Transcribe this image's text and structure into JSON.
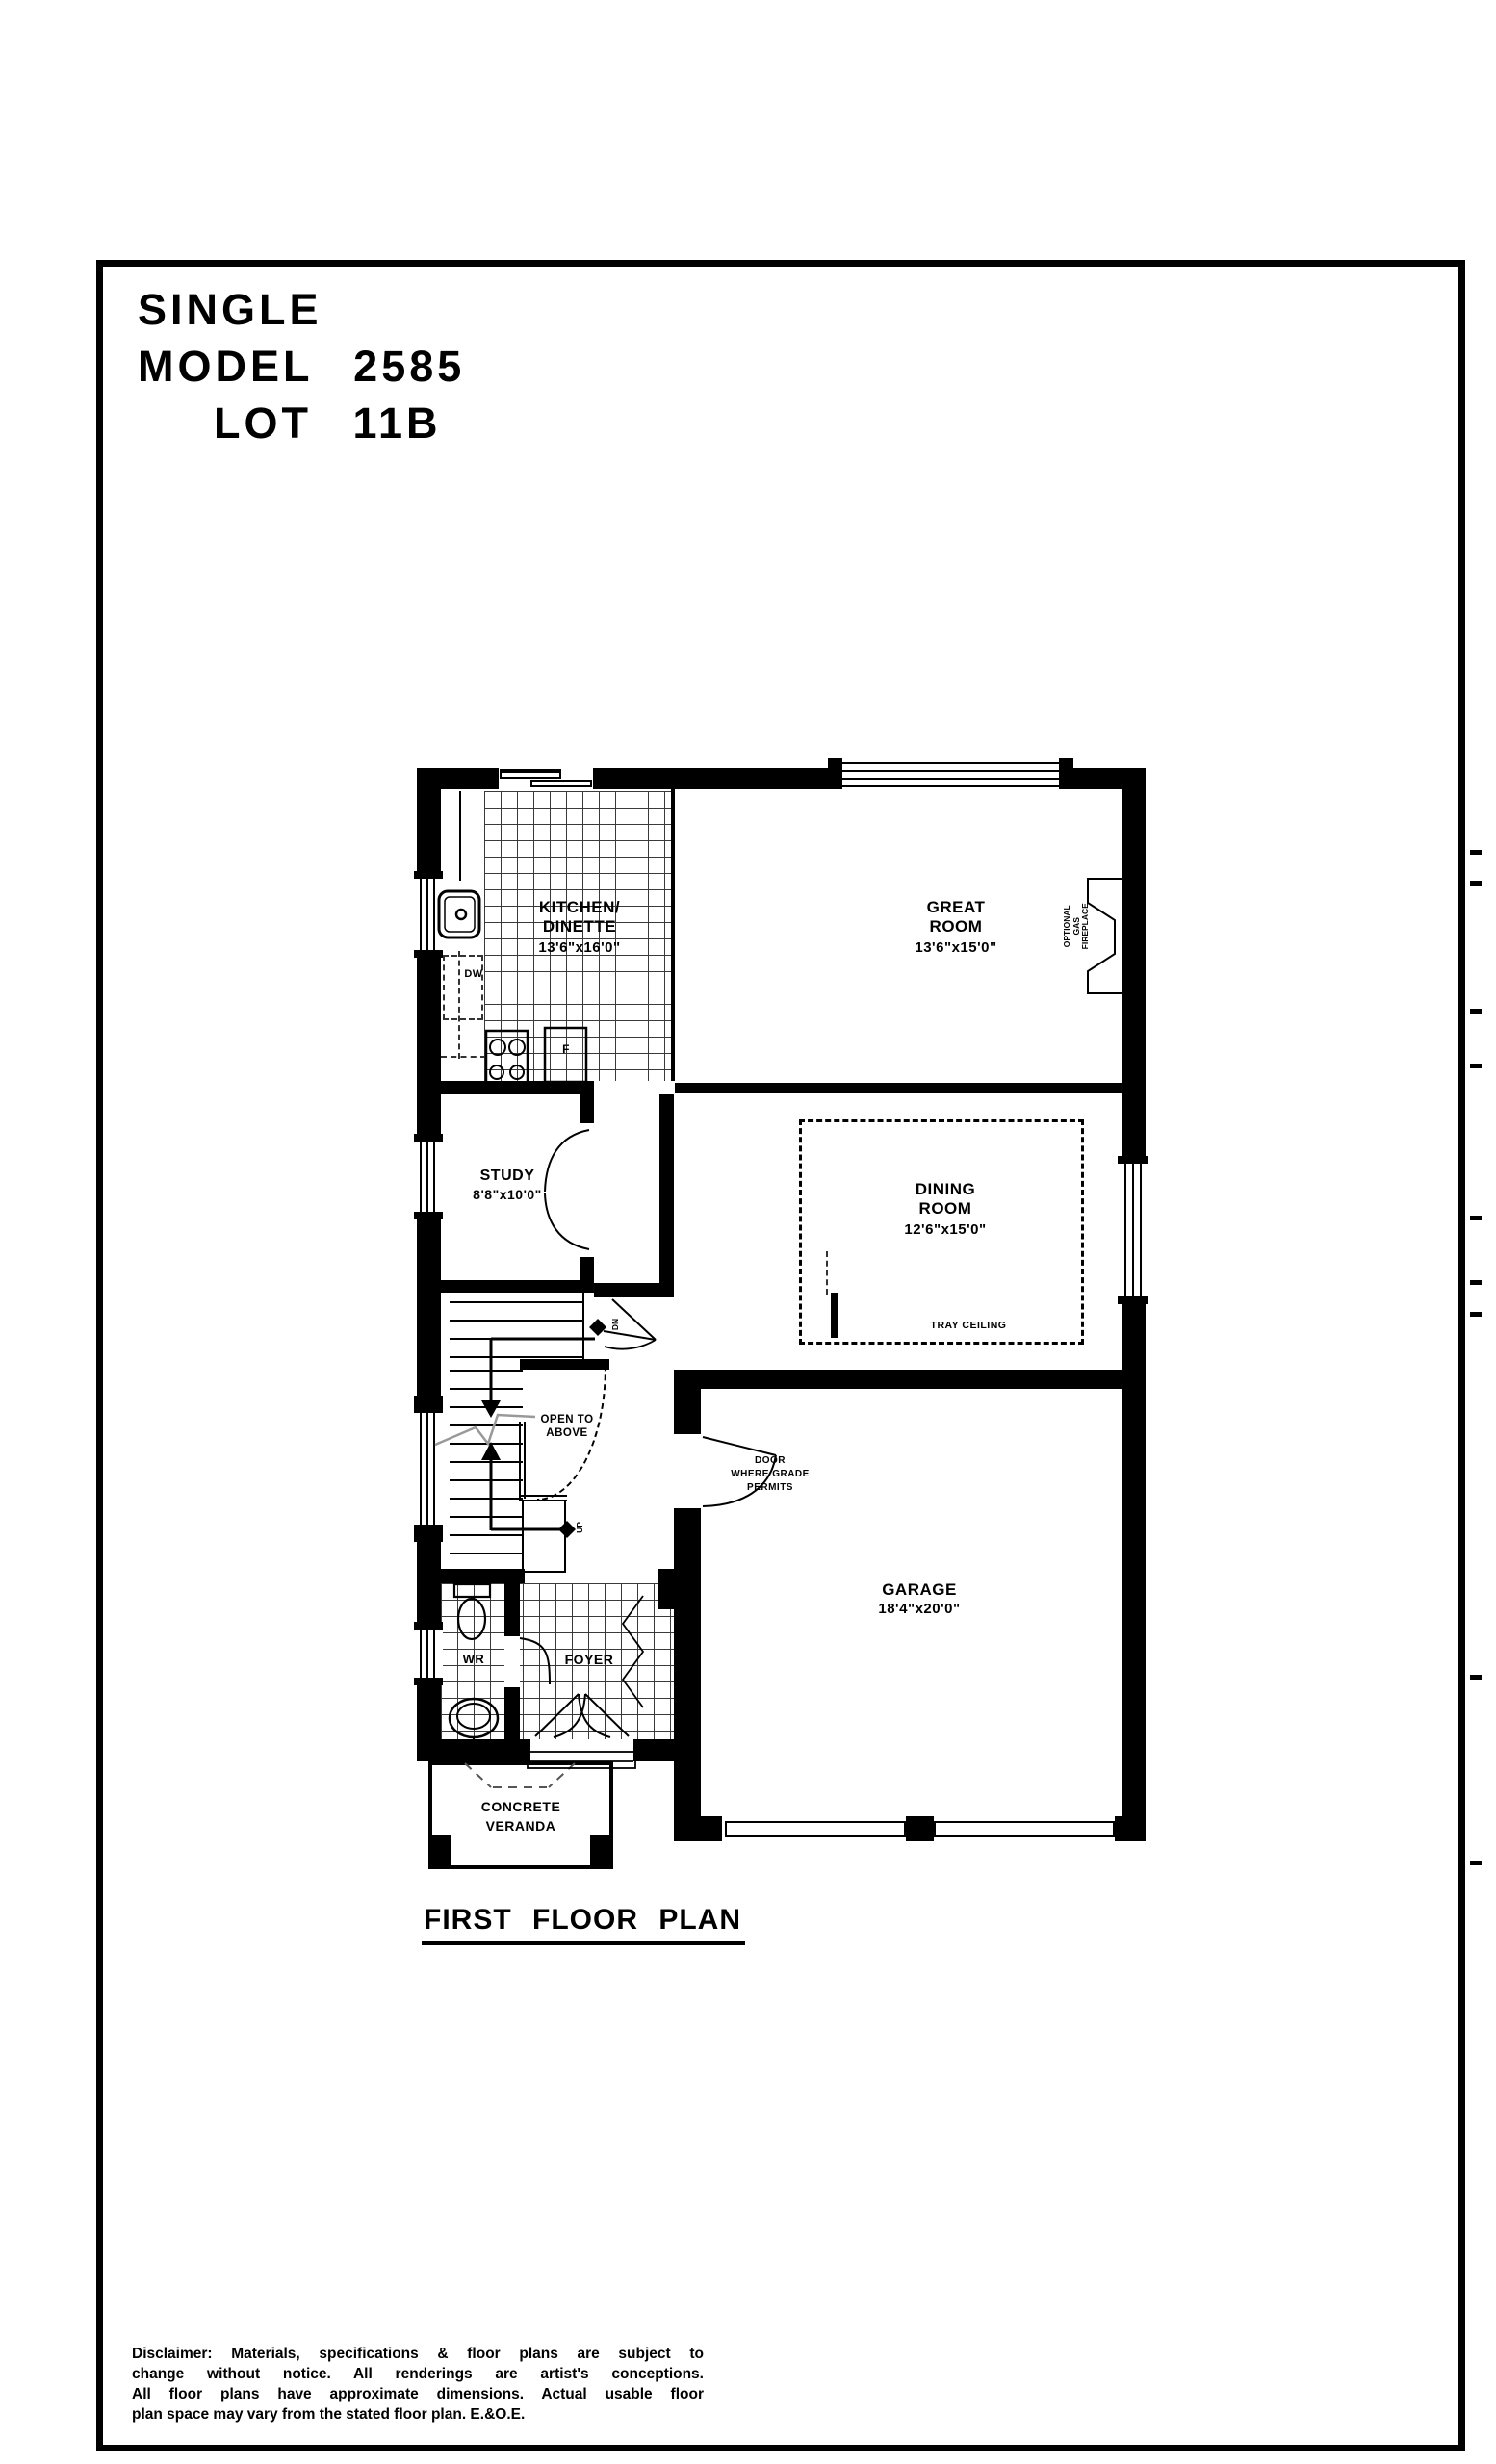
{
  "colors": {
    "ink": "#000000",
    "paper": "#ffffff",
    "tile_line": "#3a3a3a",
    "break_line": "#999999"
  },
  "title_block": {
    "line1": "SINGLE",
    "line2": "MODEL 2585",
    "line3": "LOT 11B"
  },
  "plan_title": "FIRST FLOOR PLAN",
  "rooms": {
    "kitchen": {
      "name_line1": "KITCHEN/",
      "name_line2": "DINETTE",
      "dims": "13'6\"x16'0\""
    },
    "great_room": {
      "name_line1": "GREAT",
      "name_line2": "ROOM",
      "dims": "13'6\"x15'0\""
    },
    "study": {
      "name": "STUDY",
      "dims": "8'8\"x10'0\""
    },
    "dining": {
      "name_line1": "DINING",
      "name_line2": "ROOM",
      "dims": "12'6\"x15'0\"",
      "ceiling_note": "TRAY CEILING"
    },
    "garage": {
      "name": "GARAGE",
      "dims": "18'4\"x20'0\"",
      "door_note_line1": "DOOR",
      "door_note_line2": "WHERE GRADE",
      "door_note_line3": "PERMITS"
    },
    "wr": {
      "name": "WR"
    },
    "foyer": {
      "name": "FOYER"
    },
    "veranda": {
      "name_line1": "CONCRETE",
      "name_line2": "VERANDA"
    },
    "stairs": {
      "open_line1": "OPEN TO",
      "open_line2": "ABOVE",
      "down_label": "DN",
      "up_label": "UP"
    }
  },
  "appliances": {
    "dishwasher": "DW",
    "fridge": "F"
  },
  "fireplace": {
    "line1": "OPTIONAL",
    "line2": "GAS",
    "line3": "FIREPLACE"
  },
  "disclaimer": {
    "line1": "Disclaimer:  Materials, specifications & floor plans are subject to",
    "line2": "change without notice.  All renderings are artist's conceptions.",
    "line3": "All floor plans have approximate dimensions.  Actual usable floor",
    "line4": "plan space may vary from the stated floor plan. E.&O.E."
  }
}
